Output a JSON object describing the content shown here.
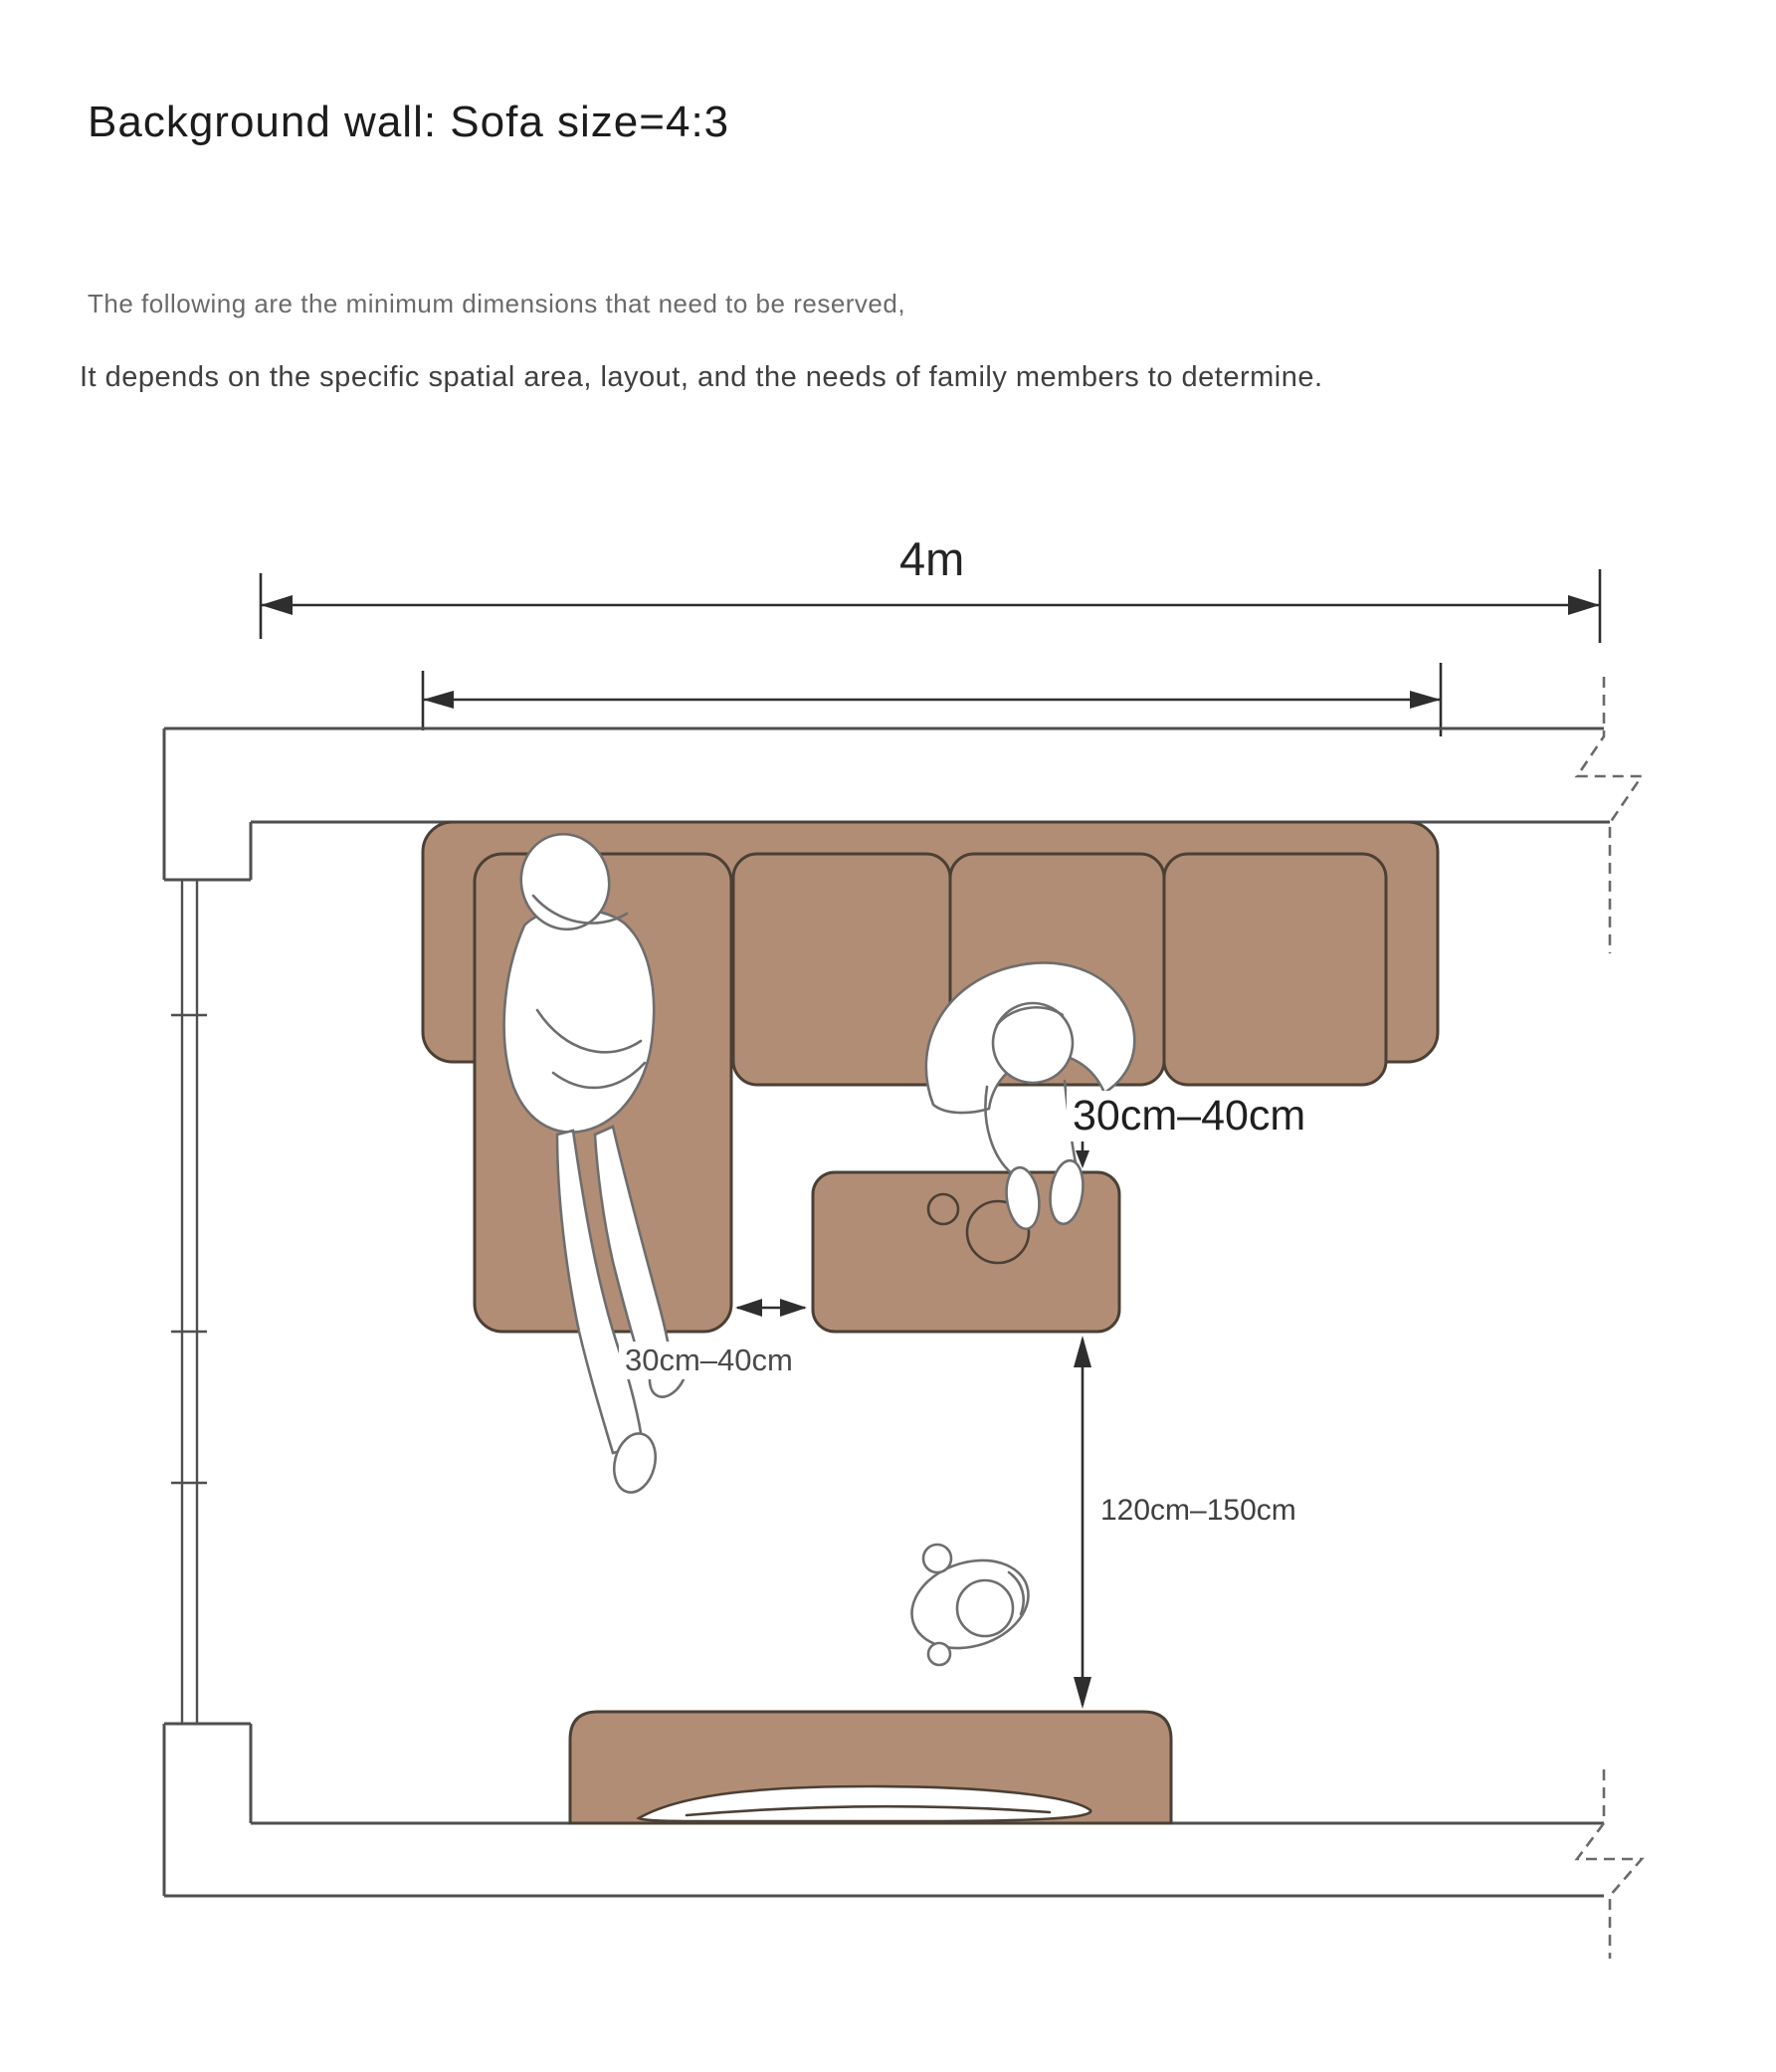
{
  "theme": {
    "bg": "#ffffff",
    "furniture-fill": "#b28d75",
    "furniture-stroke": "#4a4036",
    "wall-stroke": "#4f4f4f",
    "dim-stroke": "#2e2e2e",
    "break-stroke": "#6a6a6a",
    "figure-stroke": "#6e6e6e",
    "title-color": "#1c1c1c",
    "subtitle1-color": "#6a6a6a",
    "subtitle2-color": "#3f3f3f",
    "label-dark": "#1f1f1f",
    "label-mid": "#4a4a4a"
  },
  "header": {
    "title": "Background wall: Sofa size=4:3",
    "subtitle_line1": "The following are the minimum dimensions that need to be reserved,",
    "subtitle_line2": "It depends on the specific spatial area, layout, and the needs of family members to determine."
  },
  "dimensions": {
    "room_width_label": "4m",
    "chaise_table_gap_label": "30cm–40cm",
    "sofa_table_gap_label": "30cm–40cm",
    "table_tv_distance_label": "120cm–150cm"
  }
}
